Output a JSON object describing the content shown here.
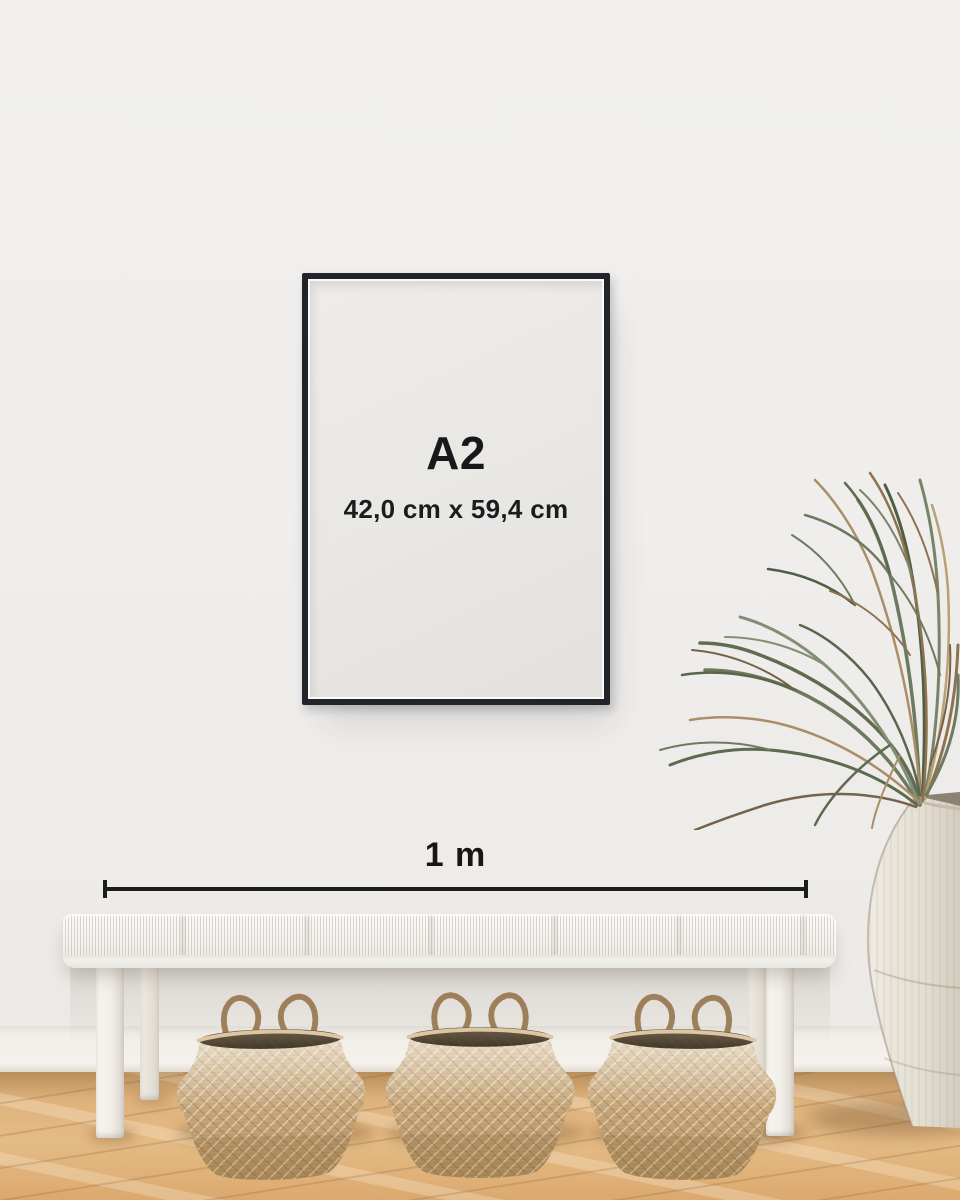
{
  "poster": {
    "size_label": "A2",
    "dimensions_label": "42,0 cm x 59,4 cm"
  },
  "measurement": {
    "label": "1 m"
  },
  "colors": {
    "wall": "#efedeb",
    "baseboard": "#f3f0ec",
    "floor_wood": "#dfb27c",
    "frame": "#212428",
    "poster_bg": "#e9e7e4",
    "poster_text": "#17181a",
    "ruler_line": "#1c1c1c",
    "bench": "#f4f2ee",
    "basket_tan": "#c9a97e",
    "basket_dark_opening": "#4e4336",
    "plant_green": "#6d7a5f",
    "plant_brown": "#a98e66",
    "urn_cream": "#e9e4d9"
  }
}
